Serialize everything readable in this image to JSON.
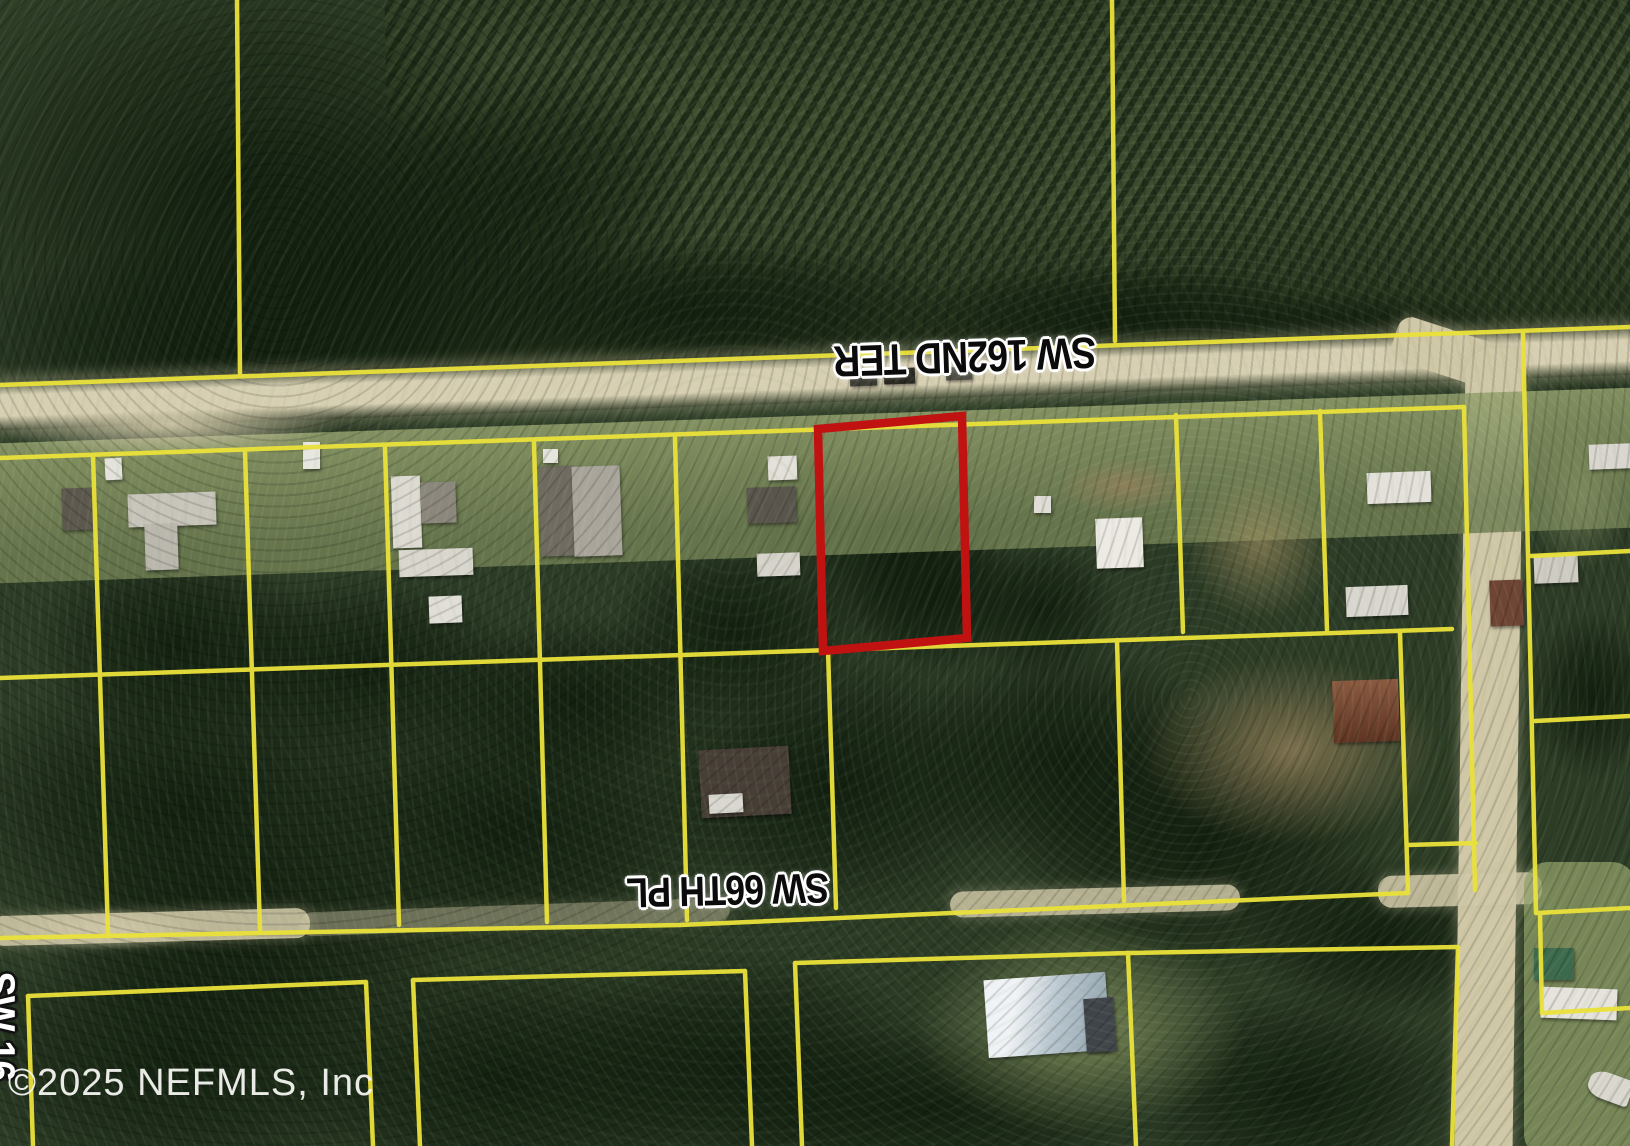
{
  "map": {
    "street_labels": {
      "top": "SW 162ND TER",
      "middle": "SW 66TH PL",
      "left_partial": "SW 16"
    },
    "watermark": "©2025 NEFMLS, Inc",
    "subject_parcel": {
      "outline_color": "#c11212"
    },
    "colors": {
      "yellow": "#eae23a",
      "red": "#c11212",
      "road": "#d7cfb2",
      "sand": "#cfc7a6",
      "forest": "#2b3b25",
      "label": "#0b0b0b",
      "halo": "#ffffff",
      "watermark": "#f5f5f2"
    }
  }
}
